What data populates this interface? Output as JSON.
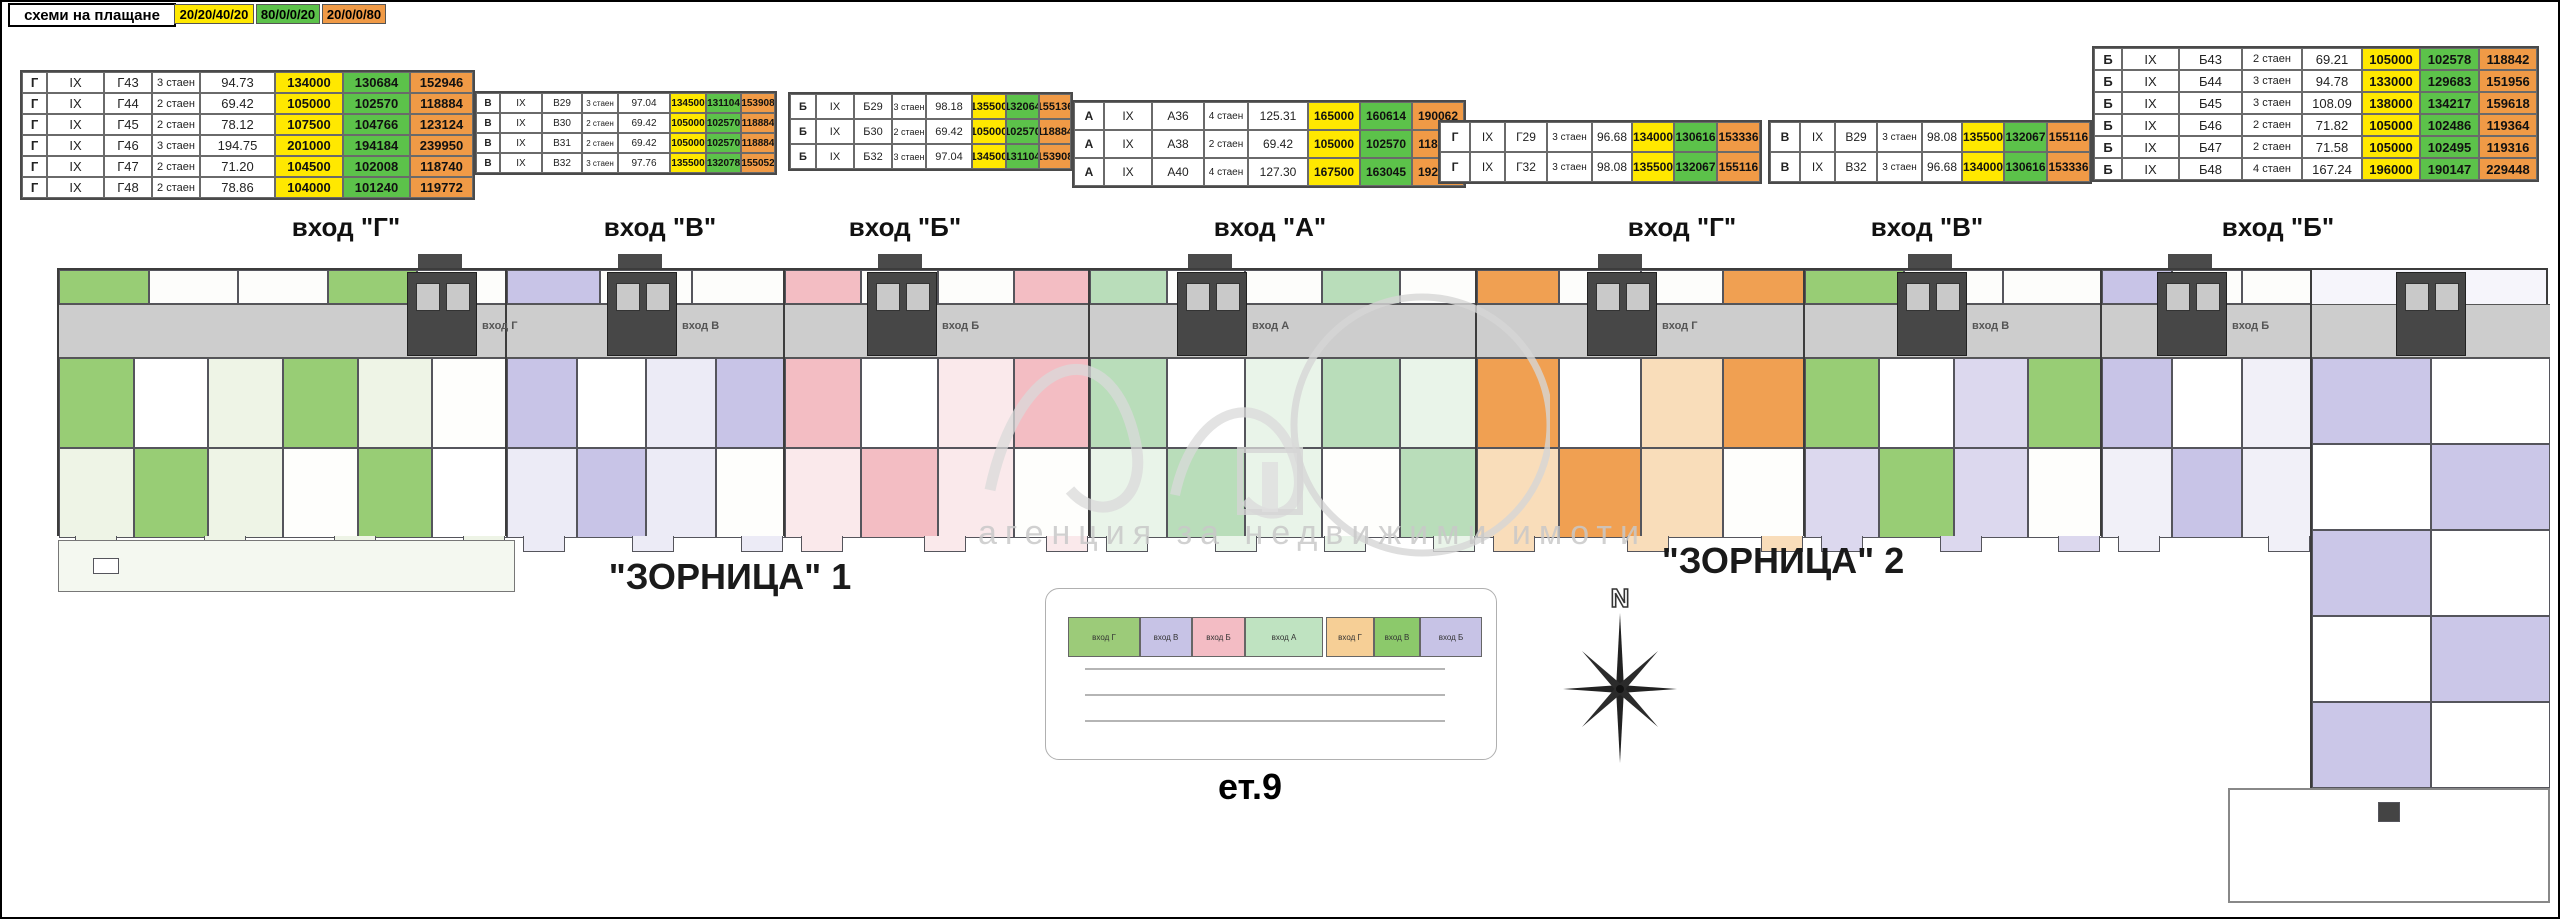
{
  "payment": {
    "label": "схеми на плащане",
    "schemes": [
      {
        "text": "20/20/40/20",
        "color": "#ffe800"
      },
      {
        "text": "80/0/0/20",
        "color": "#5cc24a"
      },
      {
        "text": "20/0/0/80",
        "color": "#f09a46"
      }
    ]
  },
  "price_tables": [
    {
      "x": 20,
      "y": 70,
      "rh": 21,
      "fs": 13,
      "widths": [
        25,
        57,
        48,
        48,
        75,
        68,
        67,
        63
      ],
      "rows": [
        [
          "Г",
          "IX",
          "Г43",
          "3 стаен",
          "94.73",
          "134000",
          "130684",
          "152946"
        ],
        [
          "Г",
          "IX",
          "Г44",
          "2 стаен",
          "69.42",
          "105000",
          "102570",
          "118884"
        ],
        [
          "Г",
          "IX",
          "Г45",
          "2 стаен",
          "78.12",
          "107500",
          "104766",
          "123124"
        ],
        [
          "Г",
          "IX",
          "Г46",
          "3 стаен",
          "194.75",
          "201000",
          "194184",
          "239950"
        ],
        [
          "Г",
          "IX",
          "Г47",
          "2 стаен",
          "71.20",
          "104500",
          "102008",
          "118740"
        ],
        [
          "Г",
          "IX",
          "Г48",
          "2 стаен",
          "78.86",
          "104000",
          "101240",
          "119772"
        ]
      ]
    },
    {
      "x": 474,
      "y": 91,
      "rh": 20,
      "fs": 10,
      "widths": [
        24,
        42,
        40,
        36,
        52,
        36,
        35,
        34
      ],
      "rows": [
        [
          "В",
          "IX",
          "В29",
          "3 стаен",
          "97.04",
          "134500",
          "131104",
          "153908"
        ],
        [
          "В",
          "IX",
          "В30",
          "2 стаен",
          "69.42",
          "105000",
          "102570",
          "118884"
        ],
        [
          "В",
          "IX",
          "В31",
          "2 стаен",
          "69.42",
          "105000",
          "102570",
          "118884"
        ],
        [
          "В",
          "IX",
          "В32",
          "3 стаен",
          "97.76",
          "135500",
          "132078",
          "155052"
        ]
      ]
    },
    {
      "x": 788,
      "y": 92,
      "rh": 25,
      "fs": 11,
      "widths": [
        26,
        38,
        38,
        34,
        46,
        34,
        33,
        32
      ],
      "rows": [
        [
          "Б",
          "IX",
          "Б29",
          "3 стаен",
          "98.18",
          "135500",
          "132064",
          "155136"
        ],
        [
          "Б",
          "IX",
          "Б30",
          "2 стаен",
          "69.42",
          "105000",
          "102570",
          "118884"
        ],
        [
          "Б",
          "IX",
          "Б32",
          "3 стаен",
          "97.04",
          "134500",
          "131104",
          "153908"
        ]
      ]
    },
    {
      "x": 1072,
      "y": 100,
      "rh": 28,
      "fs": 12,
      "widths": [
        30,
        48,
        52,
        44,
        60,
        52,
        52,
        52
      ],
      "rows": [
        [
          "А",
          "IX",
          "А36",
          "4 стаен",
          "125.31",
          "165000",
          "160614",
          "190062"
        ],
        [
          "А",
          "IX",
          "А38",
          "2 стаен",
          "69.42",
          "105000",
          "102570",
          "118884"
        ],
        [
          "А",
          "IX",
          "А40",
          "4 стаен",
          "127.30",
          "167500",
          "163045",
          "192960"
        ]
      ]
    },
    {
      "x": 1438,
      "y": 120,
      "rh": 30,
      "fs": 12,
      "widths": [
        30,
        35,
        42,
        45,
        40,
        42,
        43,
        43
      ],
      "rows": [
        [
          "Г",
          "IX",
          "Г29",
          "3 стаен",
          "96.68",
          "134000",
          "130616",
          "153336"
        ],
        [
          "Г",
          "IX",
          "Г32",
          "3 стаен",
          "98.08",
          "135500",
          "132067",
          "155116"
        ]
      ]
    },
    {
      "x": 1768,
      "y": 120,
      "rh": 30,
      "fs": 12,
      "widths": [
        30,
        35,
        42,
        45,
        40,
        42,
        43,
        43
      ],
      "rows": [
        [
          "В",
          "IX",
          "В29",
          "3 стаен",
          "98.08",
          "135500",
          "132067",
          "155116"
        ],
        [
          "В",
          "IX",
          "В32",
          "3 стаен",
          "96.68",
          "134000",
          "130616",
          "153336"
        ]
      ]
    },
    {
      "x": 2092,
      "y": 46,
      "rh": 22,
      "fs": 13,
      "widths": [
        28,
        57,
        63,
        60,
        60,
        58,
        59,
        58
      ],
      "rows": [
        [
          "Б",
          "IX",
          "Б43",
          "2 стаен",
          "69.21",
          "105000",
          "102578",
          "118842"
        ],
        [
          "Б",
          "IX",
          "Б44",
          "3 стаен",
          "94.78",
          "133000",
          "129683",
          "151956"
        ],
        [
          "Б",
          "IX",
          "Б45",
          "3 стаен",
          "108.09",
          "138000",
          "134217",
          "159618"
        ],
        [
          "Б",
          "IX",
          "Б46",
          "2 стаен",
          "71.82",
          "105000",
          "102486",
          "119364"
        ],
        [
          "Б",
          "IX",
          "Б47",
          "2 стаен",
          "71.58",
          "105000",
          "102495",
          "119316"
        ],
        [
          "Б",
          "IX",
          "Б48",
          "4 стаен",
          "167.24",
          "196000",
          "190147",
          "229448"
        ]
      ]
    }
  ],
  "entrance_headers": [
    {
      "text": "вход \"Г\"",
      "x": 346
    },
    {
      "text": "вход \"В\"",
      "x": 660
    },
    {
      "text": "вход \"Б\"",
      "x": 905
    },
    {
      "text": "вход \"А\"",
      "x": 1270
    },
    {
      "text": "вход \"Г\"",
      "x": 1682
    },
    {
      "text": "вход \"В\"",
      "x": 1927
    },
    {
      "text": "вход \"Б\"",
      "x": 2278
    }
  ],
  "building_titles": [
    {
      "text": "\"ЗОРНИЦА\" 1",
      "x": 730,
      "y": 556
    },
    {
      "text": "\"ЗОРНИЦА\" 2",
      "x": 1783,
      "y": 540
    }
  ],
  "plan": {
    "sections": [
      {
        "label": "вход Г",
        "x0": 57,
        "x1": 505,
        "sat": "#98cd75",
        "pale": "#eef4e6",
        "core": 440
      },
      {
        "label": "вход В",
        "x0": 505,
        "x1": 783,
        "sat": "#c8c4e7",
        "pale": "#ecebf6",
        "core": 640
      },
      {
        "label": "вход Б",
        "x0": 783,
        "x1": 1088,
        "sat": "#f3bdc3",
        "pale": "#fae9eb",
        "core": 900
      },
      {
        "label": "вход А",
        "x0": 1088,
        "x1": 1475,
        "sat": "#b9ddba",
        "pale": "#e9f4e9",
        "core": 1210
      },
      {
        "label": "вход Г",
        "x0": 1475,
        "x1": 1803,
        "sat": "#f0a052",
        "pale": "#f9ddba",
        "core": 1620
      },
      {
        "label": "вход В",
        "x0": 1803,
        "x1": 2100,
        "sat": "#98cd75",
        "pale": "#dcd8ee",
        "core": 1930
      },
      {
        "label": "вход Б",
        "x0": 2100,
        "x1": 2310,
        "sat": "#c8c4e7",
        "pale": "#f1f0f8",
        "core": 2190
      }
    ],
    "left_terrace": {
      "x": 58,
      "y": 540,
      "w": 457,
      "h": 52
    },
    "tower": {
      "x": 2310,
      "y": 268,
      "w": 238,
      "h": 520,
      "sat": "#cbc7e8",
      "pale": "#f6f5fb"
    },
    "right_terrace": {
      "x": 2228,
      "y": 788,
      "w": 322,
      "h": 115
    }
  },
  "site_plan": {
    "blocks": [
      {
        "label": "вход Г",
        "color": "#9ccb79",
        "x": 1068,
        "w": 72
      },
      {
        "label": "вход В",
        "color": "#c7c3e6",
        "x": 1140,
        "w": 52
      },
      {
        "label": "вход Б",
        "color": "#f3bcc4",
        "x": 1192,
        "w": 53
      },
      {
        "label": "вход А",
        "color": "#bfe3c1",
        "x": 1245,
        "w": 78
      },
      {
        "label": "вход Г",
        "color": "#f6cf96",
        "x": 1326,
        "w": 48
      },
      {
        "label": "вход В",
        "color": "#8cc96b",
        "x": 1374,
        "w": 46
      },
      {
        "label": "вход Б",
        "color": "#c7c3e6",
        "x": 1420,
        "w": 62
      }
    ],
    "floor_label": "ет.9"
  },
  "compass": {
    "label": "N"
  },
  "watermark": {
    "agency": "агенция за недвижими имоти"
  }
}
